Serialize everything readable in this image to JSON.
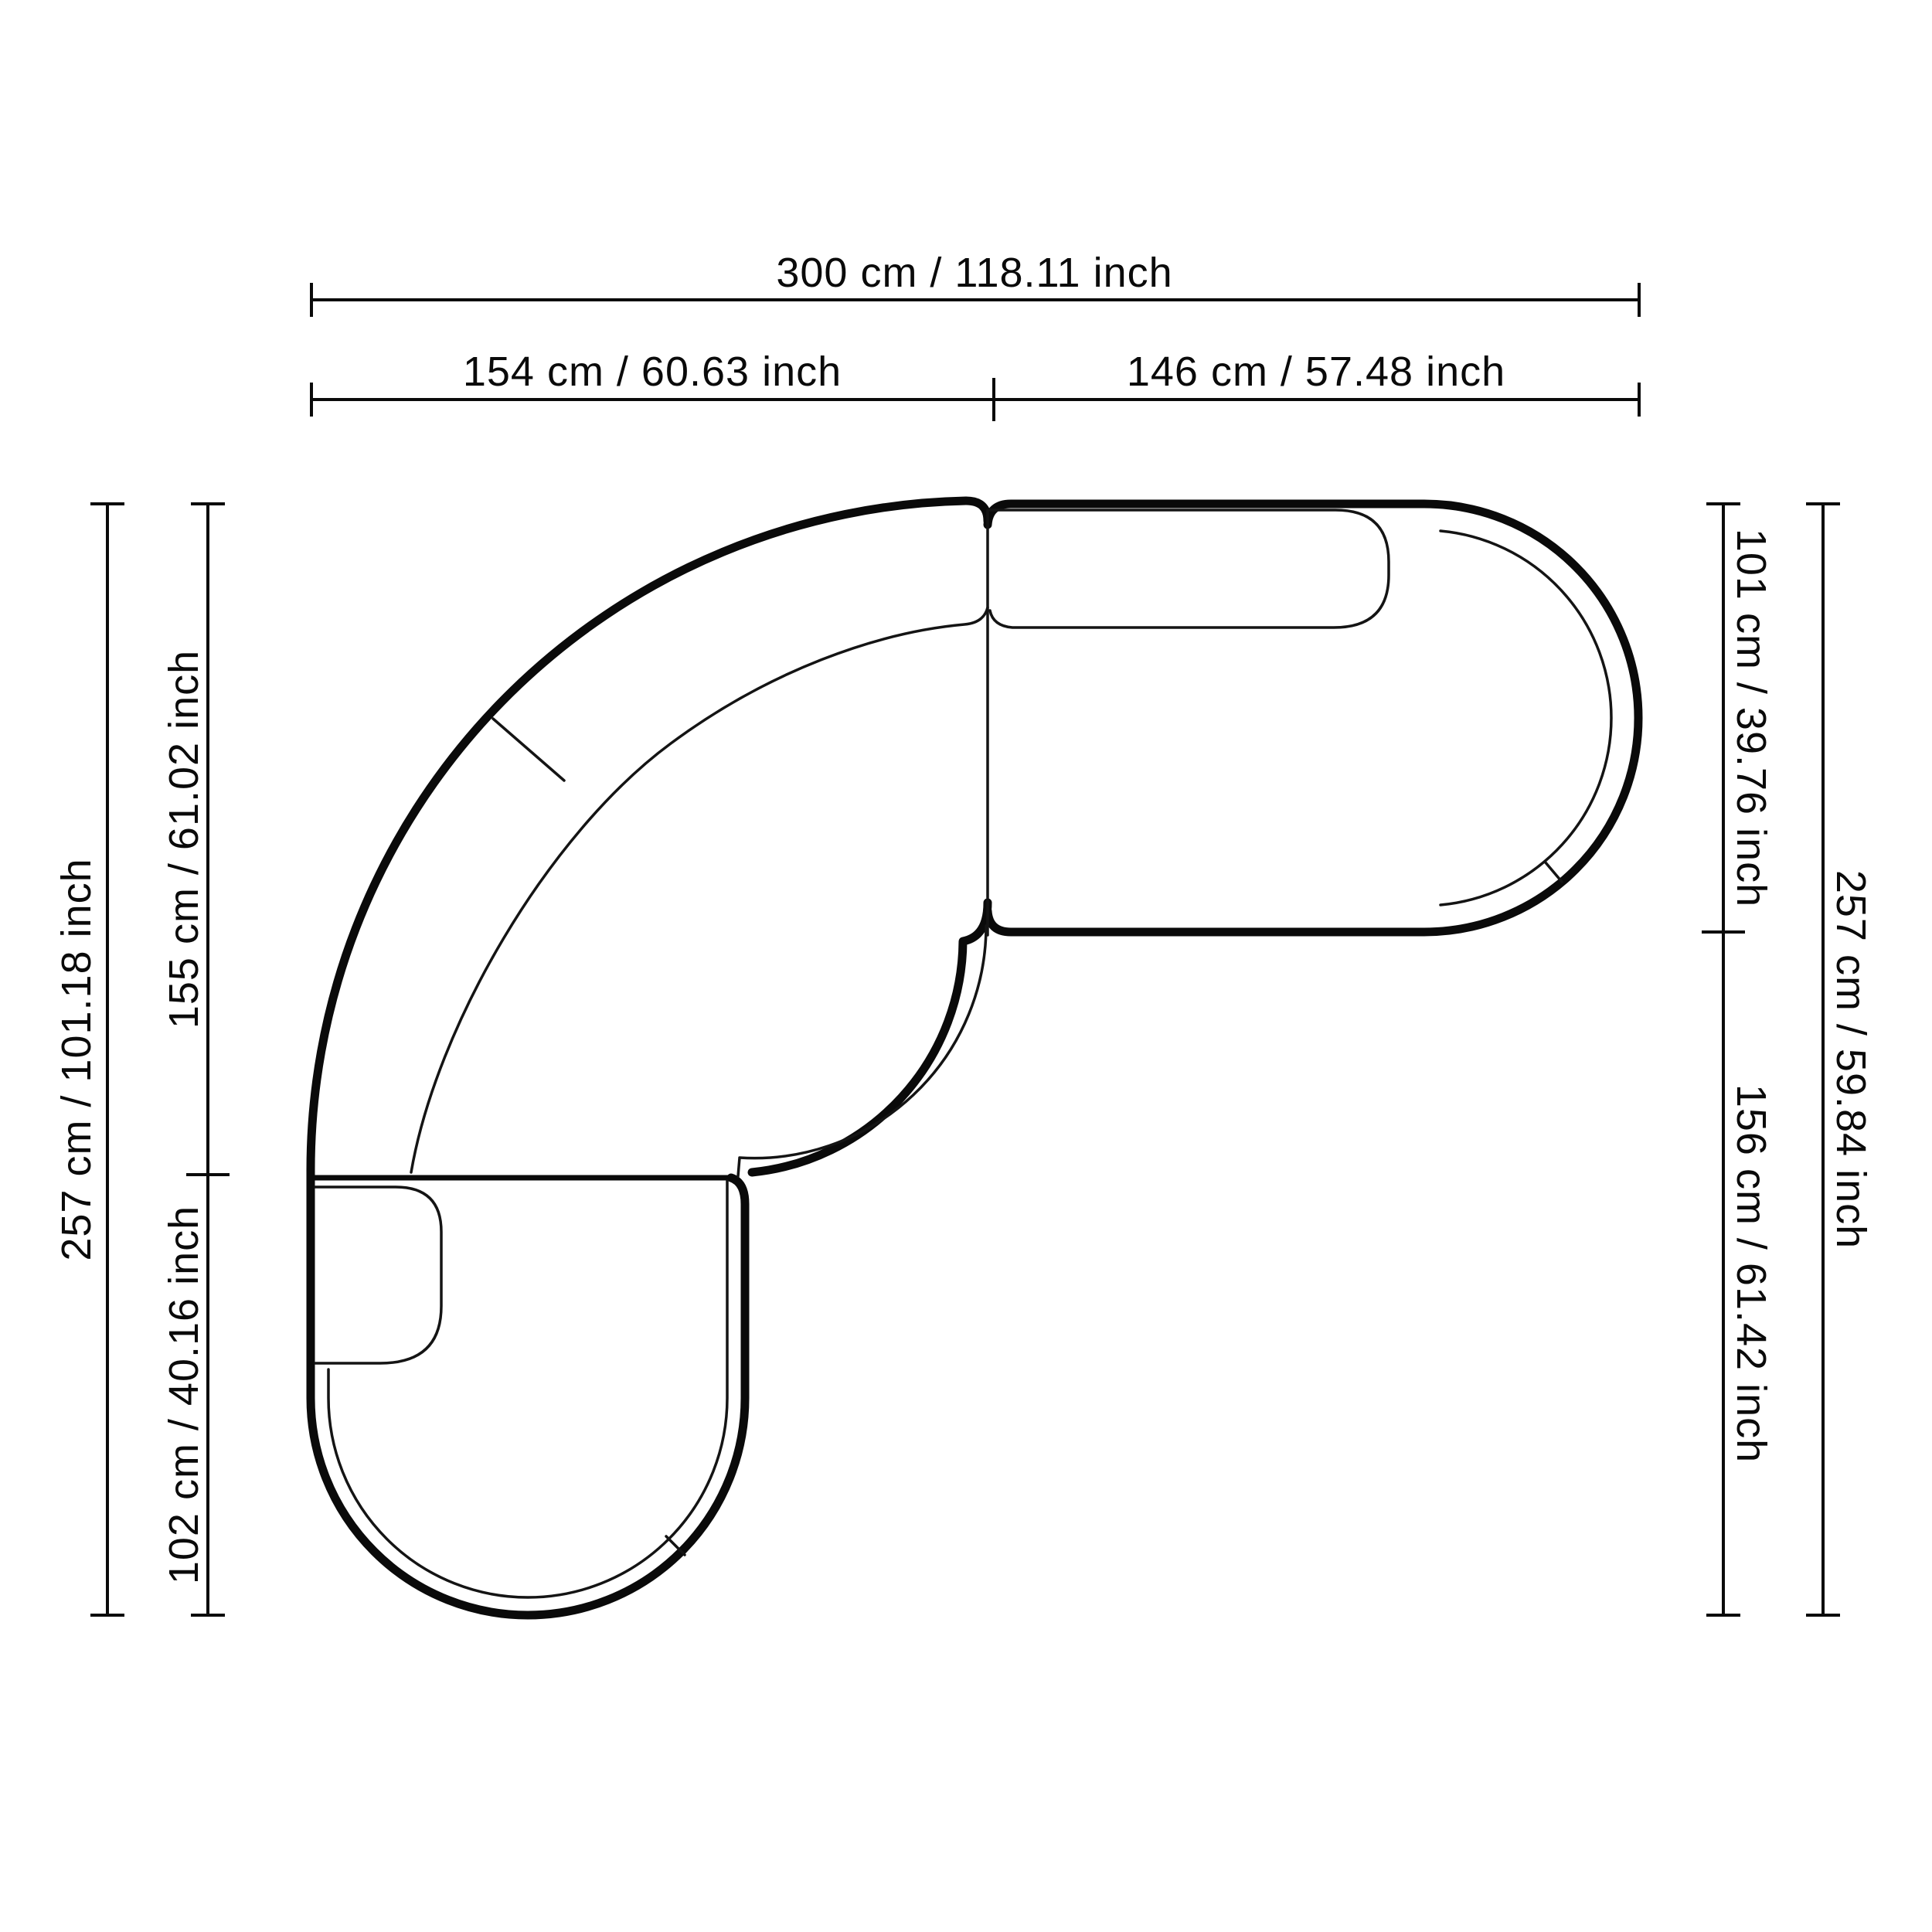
{
  "diagram": {
    "type": "furniture-dimension-drawing",
    "subject": "curved-sectional-sofa-top-view",
    "colors": {
      "background": "#ffffff",
      "line": "#0a0a0a",
      "text": "#0a0a0a"
    },
    "labels": {
      "top_total": "300 cm / 118.11 inch",
      "top_left_segment": "154 cm / 60.63 inch",
      "top_right_segment": "146 cm / 57.48 inch",
      "left_total": "257 cm / 101.18 inch",
      "left_upper_segment": "155 cm / 61.02 inch",
      "left_lower_segment": "102 cm / 40.16 inch",
      "right_upper_segment": "101 cm / 39.76 inch",
      "right_lower_segment": "156 cm / 61.42 inch",
      "right_total": "257 cm / 59.84 inch"
    }
  }
}
